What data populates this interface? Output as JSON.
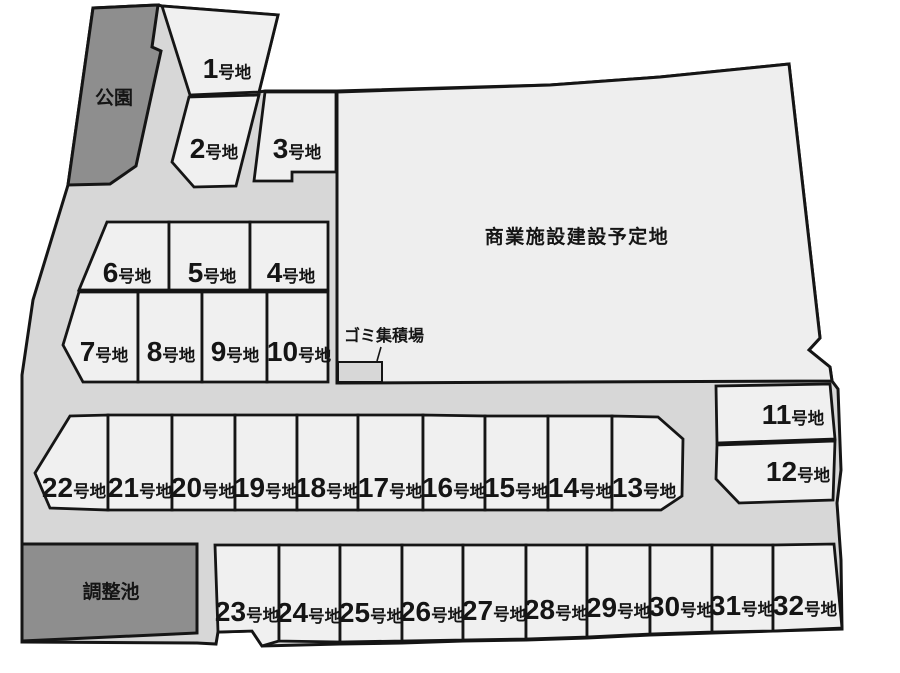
{
  "map": {
    "park": {
      "label": "公園"
    },
    "commercial": {
      "label": "商業施設建設予定地"
    },
    "garbage": {
      "label": "ゴミ集積場"
    },
    "pond": {
      "label": "調整池"
    },
    "plot_suffix": "号地",
    "plots": [
      {
        "number": "1"
      },
      {
        "number": "2"
      },
      {
        "number": "3"
      },
      {
        "number": "4"
      },
      {
        "number": "5"
      },
      {
        "number": "6"
      },
      {
        "number": "7"
      },
      {
        "number": "8"
      },
      {
        "number": "9"
      },
      {
        "number": "10"
      },
      {
        "number": "11"
      },
      {
        "number": "12"
      },
      {
        "number": "13"
      },
      {
        "number": "14"
      },
      {
        "number": "15"
      },
      {
        "number": "16"
      },
      {
        "number": "17"
      },
      {
        "number": "18"
      },
      {
        "number": "19"
      },
      {
        "number": "20"
      },
      {
        "number": "21"
      },
      {
        "number": "22"
      },
      {
        "number": "23"
      },
      {
        "number": "24"
      },
      {
        "number": "25"
      },
      {
        "number": "26"
      },
      {
        "number": "27"
      },
      {
        "number": "28"
      },
      {
        "number": "29"
      },
      {
        "number": "30"
      },
      {
        "number": "31"
      },
      {
        "number": "32"
      }
    ]
  },
  "colors": {
    "background": "#ffffff",
    "road": "#d7d7d7",
    "plot": "#f0f0f0",
    "commercial": "#eeeeee",
    "facility": "#8e8e8e",
    "outline": "#151515",
    "text": "#151515"
  }
}
